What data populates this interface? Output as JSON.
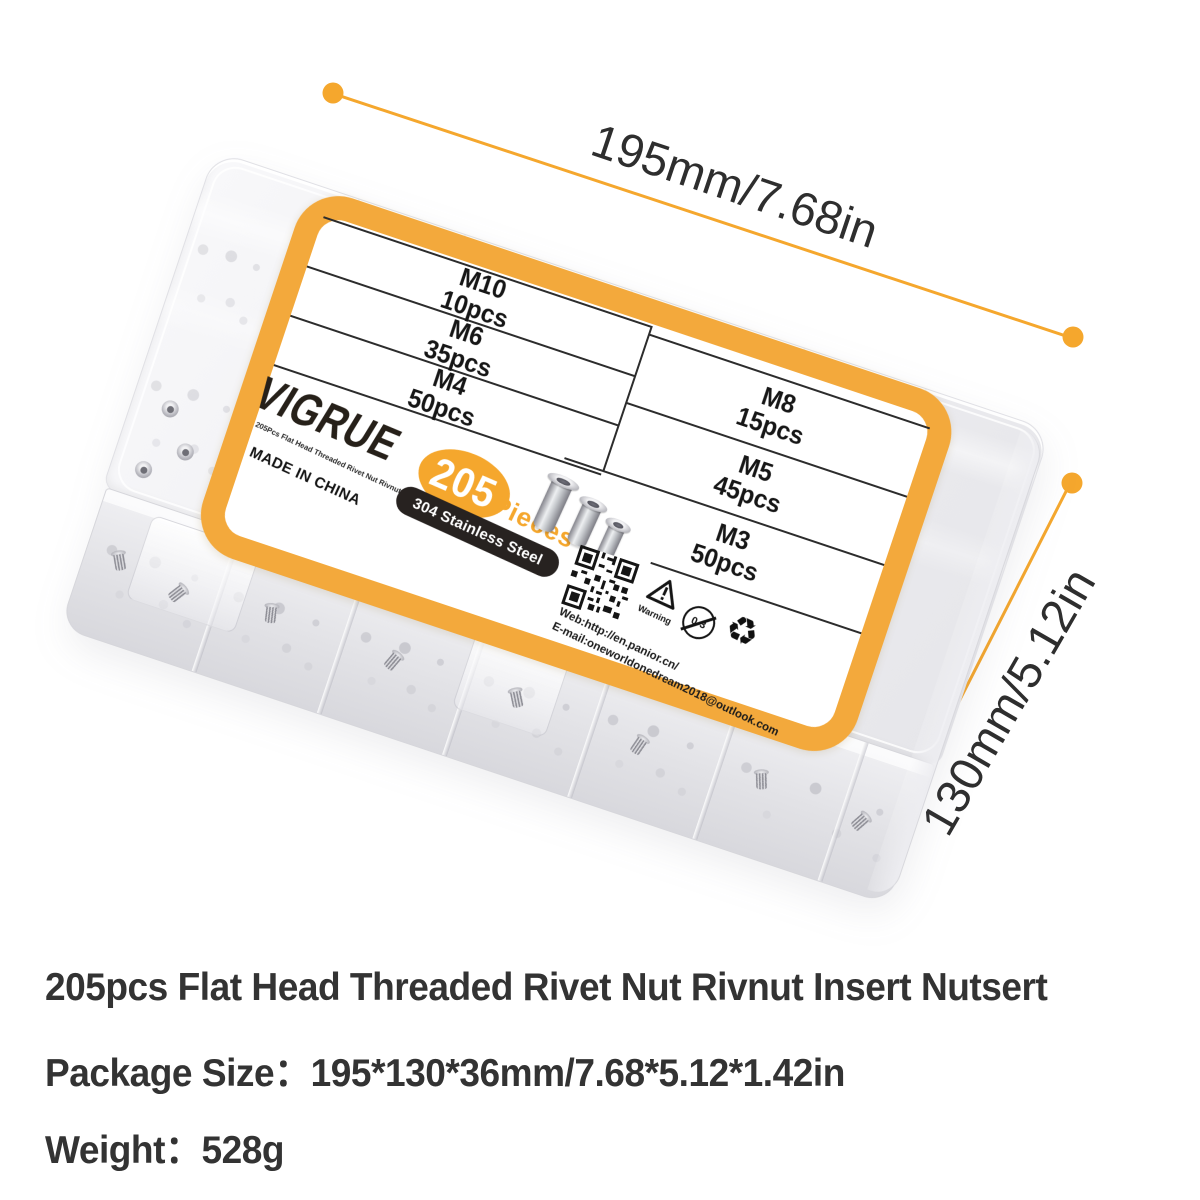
{
  "dimensions": {
    "width_label": "195mm/7.68in",
    "height_label": "130mm/5.12in"
  },
  "label": {
    "brand": "VIGRUE",
    "brand_subtitle": "205Pcs Flat Head Threaded Rivet Nut Rivnut Insert Nutsert",
    "origin": "MADE IN CHINA",
    "count_badge": {
      "number": "205",
      "unit": "Pieces"
    },
    "material_badge": "304 Stainless Steel",
    "table": {
      "left_rows": [
        {
          "size": "M10",
          "qty": "10pcs"
        },
        {
          "size": "M6",
          "qty": "35pcs"
        },
        {
          "size": "M4",
          "qty": "50pcs"
        }
      ],
      "right_rows": [
        {
          "size": "M8",
          "qty": "15pcs"
        },
        {
          "size": "M5",
          "qty": "45pcs"
        },
        {
          "size": "M3",
          "qty": "50pcs"
        }
      ]
    },
    "icons": {
      "qr": "qr-code",
      "warning": "warning-triangle",
      "age": "age-restriction-0-3",
      "recycle": "recycle-symbol"
    },
    "warning_label": "Warning",
    "age_text": "0-3",
    "recycle_glyph": "♻",
    "web": "Web:http://en.panior.cn/",
    "email": "E-mail:oneworldonedream2018@outlook.com"
  },
  "footer": {
    "line1": "205pcs Flat Head Threaded Rivet Nut Rivnut Insert Nutsert",
    "line2": "Package Size：195*130*36mm/7.68*5.12*1.42in",
    "line3": "Weight：528g"
  },
  "colors": {
    "accent_orange": "#F5A72D",
    "pill_black": "#272220",
    "text_dark": "#333333"
  }
}
